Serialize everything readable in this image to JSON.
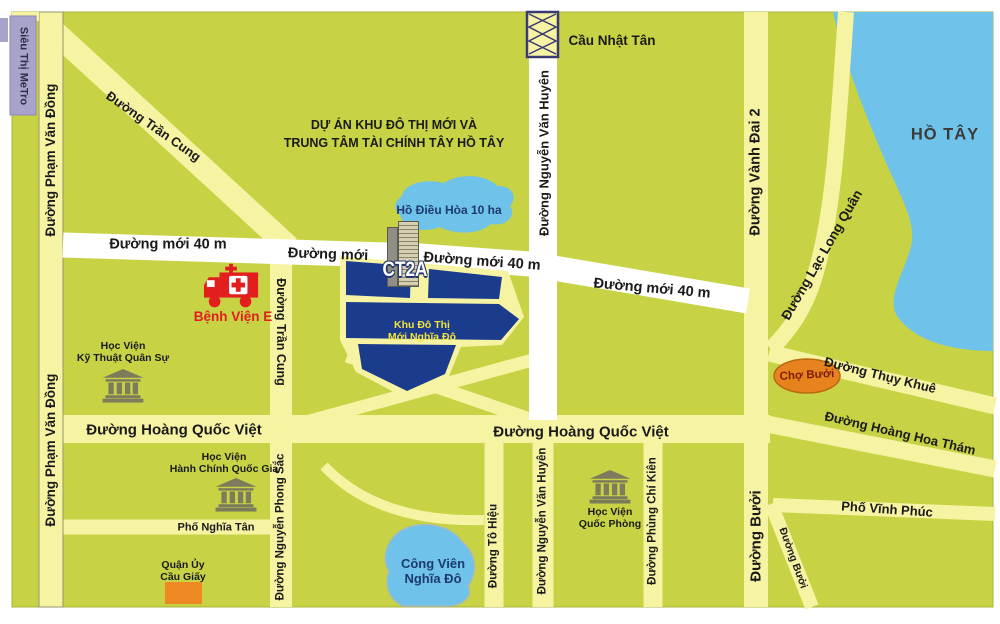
{
  "colors": {
    "land": "#c7d345",
    "road": "#f6f3a3",
    "road_white": "#ffffff",
    "water": "#6fc2e9",
    "urban_area_blue": "#1b3b8c",
    "market_orange": "#e8821f",
    "district_orange": "#ee8822",
    "metro_purple": "#a8a3cb",
    "institution_gray": "#7c7c5c",
    "hospital_red": "#e31e1e"
  },
  "roads": {
    "pham_van_dong": "Đường Phạm Văn Đồng",
    "tran_cung": "Đường Trần Cung",
    "nguyen_van_huyen": "Đường Nguyễn Văn Huyên",
    "moi_40m": "Đường mới 40 m",
    "moi": "Đường mới",
    "hoang_quoc_viet": "Đường Hoàng Quốc Việt",
    "vanh_dai_2": "Đường Vành Đai 2",
    "lac_long_quan": "Đường Lạc Long Quân",
    "thuy_khue": "Đường Thụy Khuê",
    "hoang_hoa_tham": "Đường Hoàng Hoa Thám",
    "nghia_tan": "Phố Nghĩa Tân",
    "nguyen_phong_sac": "Đường Nguyễn Phong Sắc",
    "to_hieu": "Đường Tô Hiệu",
    "phung_chi_kien": "Đường Phùng Chí Kiên",
    "buoi": "Đường Bưởi",
    "vinh_phuc": "Phố Vĩnh Phúc"
  },
  "places": {
    "metro": "Siêu Thị MeTro",
    "cau_nhat_tan": "Cầu Nhật Tân",
    "project_line1": "DỰ ÁN KHU ĐÔ THỊ MỚI VÀ",
    "project_line2": "TRUNG TÂM TÀI CHÍNH TÂY HỒ TÂY",
    "ho_dieu_hoa": "Hồ Điều Hòa 10 ha",
    "ct2a": "CT2A",
    "benh_vien_e": "Bệnh Viện E",
    "hv_ktqs_line1": "Học Viện",
    "hv_ktqs_line2": "Kỹ Thuật Quân Sự",
    "khu_do_thi_line1": "Khu Đô Thị",
    "khu_do_thi_line2": "Mới Nghĩa Đô",
    "ho_tay": "HỒ TÂY",
    "cho_buoi": "Chợ Bưởi",
    "hv_hcqg_line1": "Học Viện",
    "hv_hcqg_line2": "Hành Chính Quốc Gia",
    "quan_uy_line1": "Quận Ủy",
    "quan_uy_line2": "Cầu Giấy",
    "cong_vien_line1": "Công Viên",
    "cong_vien_line2": "Nghĩa Đô",
    "hv_qp_line1": "Học Viện",
    "hv_qp_line2": "Quốc Phòng"
  }
}
